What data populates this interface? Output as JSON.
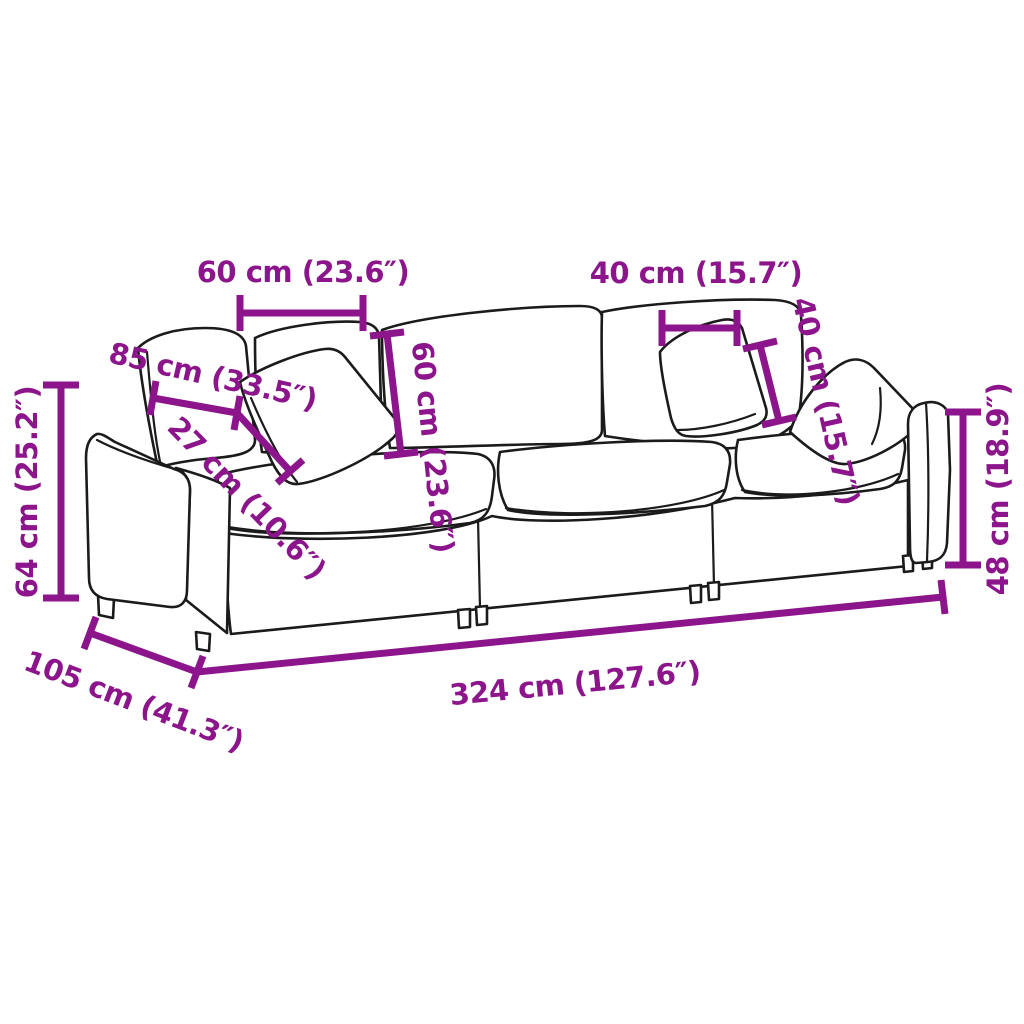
{
  "figure": {
    "kind": "product-dimension-diagram",
    "subject": "3-piece modular sofa line drawing with measurements",
    "accent_color": "#8C158C",
    "line_color": "#1b1b1b",
    "background_color": "#ffffff",
    "unit_primary": "cm",
    "unit_secondary": "inches"
  },
  "dims": {
    "pillow_left_width": {
      "label": "60 cm (23.6″)",
      "cm": 60,
      "inch": 23.6
    },
    "pillow_right_width": {
      "label": "40 cm (15.7″)",
      "cm": 40,
      "inch": 15.7
    },
    "back_cushion_width": {
      "label": "85 cm (33.5″)",
      "cm": 85,
      "inch": 33.5
    },
    "armrest_width": {
      "label": "27 cm (10.6″)",
      "cm": 27,
      "inch": 10.6
    },
    "back_height": {
      "label": "60 cm (23.6″)",
      "cm": 60,
      "inch": 23.6
    },
    "pillow_right_height": {
      "label": "40 cm (15.7″)",
      "cm": 40,
      "inch": 15.7
    },
    "overall_height": {
      "label": "64 cm (25.2″)",
      "cm": 64,
      "inch": 25.2
    },
    "arm_height": {
      "label": "48 cm (18.9″)",
      "cm": 48,
      "inch": 18.9
    },
    "depth": {
      "label": "105 cm (41.3″)",
      "cm": 105,
      "inch": 41.3
    },
    "overall_width": {
      "label": "324 cm (127.6″)",
      "cm": 324,
      "inch": 127.6
    }
  }
}
